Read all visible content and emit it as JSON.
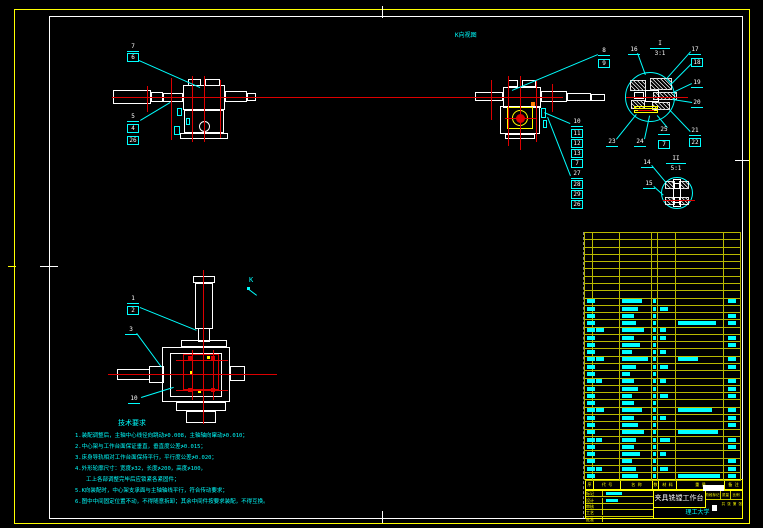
{
  "meta": {
    "width": 763,
    "height": 528
  },
  "colors": {
    "red": "#dd0000",
    "cyan": "#00ffff",
    "yellow": "#ffff00",
    "white": "#ffffff",
    "orange": "#ff8000",
    "background": "#000000"
  },
  "labels": {
    "k_view": "K向视图",
    "k_arrow": "K",
    "detail1_name": "I",
    "detail1_scale": "3:1",
    "detail2_name": "II",
    "detail2_scale": "5:1"
  },
  "tech_notes": {
    "title": "技术要求",
    "lines": [
      "1.装配调整后，主轴中心线径向跳动≯0.008，主轴轴向窜动≯0.010；",
      "2.中心架与工作台面保证垂直，垂直度公差≯0.015；",
      "3.床身导轨相对工作台面保持平行，平行度公差≯0.020；",
      "4.外形轮廓尺寸：宽度≯32，长度≯200，高度≯100，",
      "工上各部调整完毕后应锁紧各紧固件；",
      "5.K向装配时，中心架支承面与主轴轴线平行，符合传动要求；",
      "6.图中中间固定位置不动，不得随意拆卸；其余中间件按要求装配，不得互换。"
    ]
  },
  "callouts": [
    [
      "7",
      133,
      47,
      0
    ],
    [
      "6",
      133,
      57,
      1
    ],
    [
      "5",
      133,
      117,
      0
    ],
    [
      "4",
      133,
      128,
      1
    ],
    [
      "26",
      133,
      140,
      1
    ],
    [
      "8",
      604,
      51,
      0
    ],
    [
      "9",
      604,
      63,
      1
    ],
    [
      "10",
      577,
      122,
      0
    ],
    [
      "11",
      577,
      133,
      1
    ],
    [
      "12",
      577,
      143,
      1
    ],
    [
      "13",
      577,
      153,
      1
    ],
    [
      "7",
      577,
      163,
      1
    ],
    [
      "27",
      577,
      174,
      0
    ],
    [
      "28",
      577,
      184,
      1
    ],
    [
      "29",
      577,
      194,
      1
    ],
    [
      "26",
      577,
      204,
      1
    ],
    [
      "16",
      634,
      50,
      0
    ],
    [
      "17",
      695,
      50,
      0
    ],
    [
      "18",
      697,
      62,
      1
    ],
    [
      "19",
      697,
      83,
      0
    ],
    [
      "20",
      697,
      103,
      0
    ],
    [
      "21",
      695,
      131,
      0
    ],
    [
      "22",
      695,
      142,
      1
    ],
    [
      "23",
      612,
      142,
      0
    ],
    [
      "24",
      640,
      142,
      0
    ],
    [
      "25",
      664,
      130,
      0
    ],
    [
      "7",
      664,
      144,
      1
    ],
    [
      "14",
      647,
      163,
      0
    ],
    [
      "15",
      649,
      184,
      0
    ],
    [
      "1",
      133,
      299,
      0
    ],
    [
      "2",
      133,
      310,
      1
    ],
    [
      "3",
      131,
      330,
      0
    ],
    [
      "10",
      134,
      399,
      0
    ]
  ],
  "leaders": [
    [
      139,
      60,
      200,
      87
    ],
    [
      140,
      120,
      170,
      102
    ],
    [
      598,
      55,
      512,
      91
    ],
    [
      570,
      124,
      544,
      113
    ],
    [
      570,
      176,
      547,
      117
    ],
    [
      638,
      53,
      646,
      75
    ],
    [
      691,
      52,
      667,
      79
    ],
    [
      692,
      64,
      671,
      85
    ],
    [
      692,
      84,
      673,
      93
    ],
    [
      692,
      103,
      672,
      100
    ],
    [
      690,
      132,
      669,
      110
    ],
    [
      616,
      139,
      636,
      114
    ],
    [
      644,
      139,
      649,
      116
    ],
    [
      667,
      128,
      657,
      116
    ],
    [
      652,
      165,
      667,
      183
    ],
    [
      654,
      186,
      664,
      195
    ],
    [
      140,
      307,
      197,
      330
    ],
    [
      137,
      333,
      162,
      367
    ],
    [
      141,
      397,
      173,
      387
    ]
  ],
  "lines": [
    [
      112,
      97,
      563,
      97,
      "r"
    ],
    [
      626,
      97,
      688,
      97,
      "r"
    ],
    [
      663,
      200,
      695,
      200,
      "r"
    ],
    [
      108,
      374,
      277,
      374,
      "r"
    ],
    [
      204,
      270,
      204,
      424,
      "r"
    ],
    [
      148,
      86,
      148,
      112,
      "r"
    ],
    [
      172,
      78,
      172,
      140,
      "r"
    ],
    [
      193,
      76,
      193,
      142,
      "r"
    ],
    [
      205,
      76,
      205,
      142,
      "r"
    ],
    [
      221,
      80,
      221,
      138,
      "r"
    ],
    [
      492,
      80,
      492,
      120,
      "r"
    ],
    [
      509,
      76,
      509,
      146,
      "r"
    ],
    [
      521,
      76,
      521,
      150,
      "r"
    ],
    [
      537,
      80,
      537,
      142,
      "r"
    ],
    [
      553,
      84,
      553,
      112,
      "r"
    ],
    [
      505,
      118,
      536,
      118,
      "r"
    ],
    [
      638,
      110,
      654,
      110,
      "r"
    ],
    [
      176,
      360,
      228,
      360,
      "r"
    ],
    [
      176,
      390,
      228,
      390,
      "r"
    ],
    [
      193,
      350,
      193,
      400,
      "r"
    ],
    [
      214,
      350,
      214,
      400,
      "r"
    ],
    [
      40,
      266,
      58,
      266,
      "w"
    ],
    [
      8,
      266,
      16,
      266,
      "y"
    ],
    [
      383,
      6,
      383,
      18,
      "w"
    ],
    [
      383,
      511,
      383,
      523,
      "w"
    ],
    [
      735,
      160,
      749,
      160,
      "w"
    ],
    [
      249,
      289,
      257,
      295,
      "c"
    ]
  ],
  "rects": [
    [
      113,
      90,
      38,
      14,
      "rw"
    ],
    [
      151,
      92,
      12,
      10,
      "rw"
    ],
    [
      163,
      93,
      20,
      9,
      "rw"
    ],
    [
      183,
      85,
      42,
      25,
      "rw"
    ],
    [
      188,
      79,
      13,
      7,
      "rw"
    ],
    [
      205,
      79,
      15,
      7,
      "rw"
    ],
    [
      225,
      91,
      22,
      11,
      "rw"
    ],
    [
      247,
      93,
      9,
      8,
      "rw"
    ],
    [
      184,
      110,
      40,
      23,
      "rw"
    ],
    [
      199,
      121,
      11,
      11,
      "rw circle"
    ],
    [
      180,
      133,
      48,
      6,
      "rw"
    ],
    [
      177,
      108,
      5,
      8,
      "rc"
    ],
    [
      186,
      118,
      4,
      7,
      "rc"
    ],
    [
      174,
      126,
      6,
      9,
      "rc"
    ],
    [
      475,
      92,
      28,
      9,
      "rw"
    ],
    [
      503,
      87,
      38,
      21,
      "rw"
    ],
    [
      541,
      91,
      26,
      11,
      "rw"
    ],
    [
      567,
      93,
      24,
      8,
      "rw"
    ],
    [
      591,
      94,
      14,
      7,
      "rw"
    ],
    [
      500,
      106,
      40,
      28,
      "rw"
    ],
    [
      505,
      134,
      30,
      5,
      "rw"
    ],
    [
      508,
      80,
      10,
      7,
      "rw"
    ],
    [
      522,
      80,
      14,
      7,
      "rw"
    ],
    [
      507,
      107,
      26,
      22,
      "ry"
    ],
    [
      512,
      110,
      16,
      16,
      "ry circle"
    ],
    [
      516,
      114,
      9,
      9,
      "fr circle"
    ],
    [
      531,
      102,
      4,
      4,
      "fo"
    ],
    [
      541,
      108,
      5,
      10,
      "rc"
    ],
    [
      543,
      120,
      4,
      8,
      "rc"
    ],
    [
      193,
      276,
      22,
      7,
      "rw"
    ],
    [
      195,
      283,
      18,
      46,
      "rw"
    ],
    [
      198,
      328,
      12,
      14,
      "rw"
    ],
    [
      181,
      340,
      46,
      7,
      "rw"
    ],
    [
      162,
      347,
      68,
      55,
      "rw"
    ],
    [
      170,
      353,
      52,
      44,
      "rw"
    ],
    [
      117,
      369,
      33,
      11,
      "rw"
    ],
    [
      149,
      366,
      15,
      17,
      "rw"
    ],
    [
      230,
      366,
      15,
      15,
      "rw"
    ],
    [
      176,
      402,
      50,
      9,
      "rw"
    ],
    [
      186,
      411,
      30,
      12,
      "rw"
    ],
    [
      183,
      354,
      36,
      36,
      "rr"
    ],
    [
      188,
      356,
      4,
      4,
      "fr"
    ],
    [
      211,
      356,
      4,
      4,
      "fr"
    ],
    [
      188,
      388,
      4,
      4,
      "fr"
    ],
    [
      211,
      388,
      4,
      4,
      "fr"
    ],
    [
      198,
      390,
      3,
      3,
      "fy"
    ],
    [
      207,
      356,
      3,
      3,
      "fy"
    ],
    [
      190,
      371,
      3,
      3,
      "fy"
    ],
    [
      625,
      72,
      50,
      50,
      "rc circle"
    ],
    [
      630,
      80,
      16,
      11,
      "hx"
    ],
    [
      650,
      78,
      22,
      12,
      "hx"
    ],
    [
      653,
      92,
      24,
      8,
      "hx"
    ],
    [
      631,
      100,
      14,
      9,
      "hx"
    ],
    [
      652,
      102,
      18,
      8,
      "hx"
    ],
    [
      645,
      90,
      14,
      12,
      "rw"
    ],
    [
      634,
      92,
      10,
      7,
      "rw"
    ],
    [
      634,
      106,
      24,
      3,
      "ry"
    ],
    [
      634,
      110,
      24,
      3,
      "ry"
    ],
    [
      661,
      177,
      32,
      32,
      "rc circle"
    ],
    [
      665,
      181,
      10,
      8,
      "hx"
    ],
    [
      679,
      181,
      10,
      8,
      "hx"
    ],
    [
      665,
      197,
      10,
      8,
      "hx"
    ],
    [
      679,
      197,
      10,
      8,
      "hx"
    ],
    [
      673,
      179,
      8,
      28,
      "rw"
    ],
    [
      674,
      183,
      6,
      6,
      "rw"
    ],
    [
      674,
      197,
      6,
      6,
      "rw"
    ],
    [
      703,
      485,
      21,
      6,
      "fw"
    ],
    [
      712,
      505,
      5,
      6,
      "fw"
    ],
    [
      247,
      287,
      3,
      3,
      "fc"
    ]
  ],
  "bom": {
    "columns": [
      585,
      593,
      620,
      652,
      658,
      676,
      724,
      741
    ],
    "col_offsets": [
      586.5,
      596,
      622,
      653,
      660,
      678,
      728
    ],
    "top": 232,
    "row_height": 7.28,
    "empty_rows": 9,
    "header": [
      "序号",
      "代 号",
      "名 称",
      "数量",
      "材 料",
      "重 量",
      "备 注"
    ],
    "header_widths": [
      8,
      27,
      32,
      6,
      18,
      48,
      17
    ],
    "rows": [
      [
        8,
        0,
        20,
        3,
        0,
        0,
        8
      ],
      [
        8,
        0,
        16,
        3,
        8,
        0,
        0
      ],
      [
        8,
        0,
        12,
        3,
        0,
        0,
        8
      ],
      [
        8,
        0,
        14,
        3,
        0,
        38,
        8
      ],
      [
        8,
        8,
        22,
        3,
        6,
        0,
        0
      ],
      [
        8,
        0,
        12,
        3,
        6,
        0,
        8
      ],
      [
        8,
        0,
        18,
        3,
        0,
        0,
        8
      ],
      [
        8,
        0,
        10,
        3,
        6,
        0,
        0
      ],
      [
        8,
        8,
        26,
        3,
        0,
        20,
        8
      ],
      [
        8,
        0,
        14,
        3,
        8,
        0,
        8
      ],
      [
        8,
        0,
        8,
        3,
        0,
        0,
        0
      ],
      [
        8,
        6,
        12,
        3,
        6,
        0,
        8
      ],
      [
        8,
        0,
        16,
        3,
        0,
        0,
        8
      ],
      [
        8,
        0,
        10,
        3,
        8,
        0,
        8
      ],
      [
        8,
        0,
        12,
        3,
        0,
        0,
        0
      ],
      [
        8,
        8,
        20,
        3,
        0,
        34,
        8
      ],
      [
        8,
        0,
        12,
        3,
        6,
        0,
        8
      ],
      [
        8,
        0,
        16,
        3,
        0,
        0,
        8
      ],
      [
        8,
        0,
        22,
        3,
        0,
        40,
        0
      ],
      [
        8,
        6,
        14,
        3,
        10,
        0,
        8
      ],
      [
        8,
        0,
        12,
        3,
        0,
        0,
        8
      ],
      [
        8,
        0,
        18,
        3,
        6,
        0,
        0
      ],
      [
        8,
        0,
        10,
        3,
        0,
        0,
        8
      ],
      [
        8,
        6,
        14,
        3,
        8,
        0,
        8
      ],
      [
        8,
        0,
        16,
        3,
        0,
        42,
        8
      ]
    ]
  },
  "title_block": {
    "title": "夹具铣镗工作台",
    "org": "理工大学",
    "left_labels": [
      "标记",
      "设计",
      "审核",
      "工艺",
      "批准"
    ],
    "stage_labels": [
      "阶段标记",
      "质量",
      "比例"
    ],
    "sheet": "共 张 第 张"
  }
}
